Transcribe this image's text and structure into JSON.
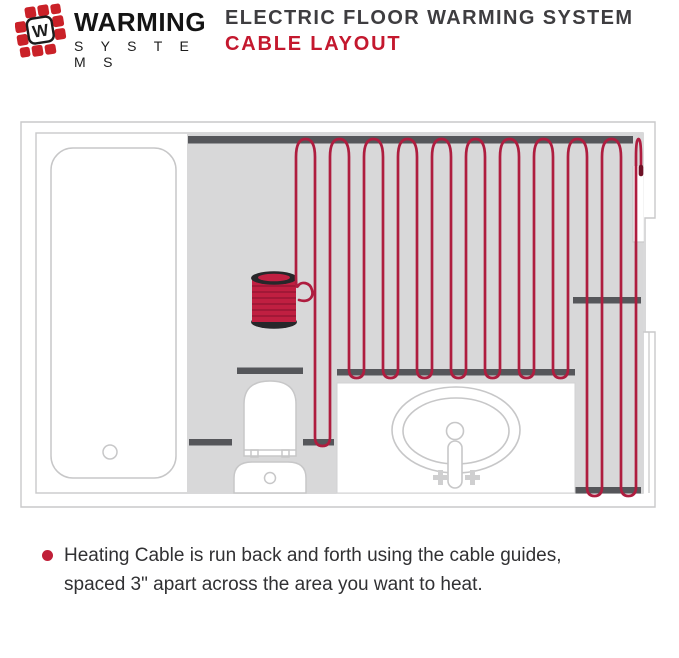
{
  "header": {
    "logo": {
      "brand_top": "WARMING",
      "brand_bottom": "S Y S T E M S",
      "mark_letter": "W"
    },
    "title_line1": "ELECTRIC FLOOR WARMING SYSTEM",
    "title_line2": "CABLE LAYOUT"
  },
  "note": {
    "line1": "Heating Cable is run back and forth using the cable guides,",
    "line2": "spaced 3\" apart across the area you want to heat."
  },
  "diagram": {
    "description": "Bathroom floor plan: bathtub left, toilet bottom center, sink vanity bottom right, cable spool, red heating cable serpentine over dark cable guides",
    "icons": [
      "bathtub",
      "toilet",
      "sink-vanity",
      "faucet",
      "cable-spool",
      "heating-cable",
      "cable-guide-strip",
      "wall-recess"
    ]
  },
  "colors": {
    "cable_red": "#ae1d3f",
    "cable_end_dark": "#6e1226",
    "accent_red": "#c4182e",
    "bullet_red": "#c01f38",
    "guide_strip": "#55565a",
    "floor_gray": "#d8d8d9",
    "fixture_outline": "#c7c7c8",
    "wall_outline": "#c9c9ca",
    "spool_flange": "#27272a",
    "spool_red": "#c01f41"
  }
}
